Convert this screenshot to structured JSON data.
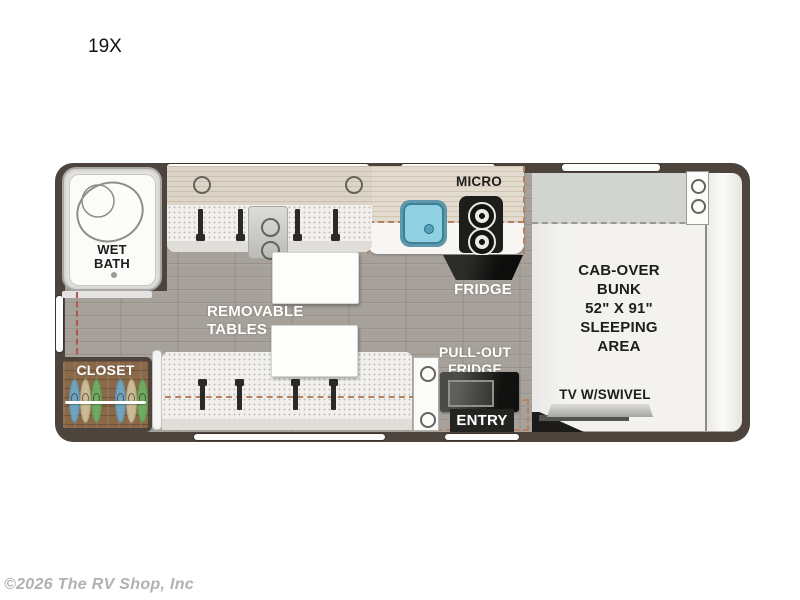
{
  "header": {
    "model_label": "19X"
  },
  "footer": {
    "copyright": "©2026 The RV Shop, Inc"
  },
  "floorplan": {
    "bath": {
      "label": "WET\nBATH"
    },
    "closet": {
      "label": "CLOSET",
      "hanger_colors": [
        "blue",
        "tan",
        "green",
        "blue",
        "tan",
        "green"
      ]
    },
    "dinette": {
      "label": "REMOVABLE\nTABLES",
      "seat_belt_count": 8,
      "table_count": 2
    },
    "kitchen": {
      "micro_label": "MICRO",
      "fridge_label": "FRIDGE"
    },
    "entry": {
      "pull_out_fridge_label": "PULL-OUT\nFRIDGE",
      "entry_label": "ENTRY"
    },
    "bunk": {
      "label": "CAB-OVER\nBUNK\n52\" X 91\"\nSLEEPING\nAREA",
      "tv_label": "TV W/SWIVEL"
    },
    "colors": {
      "wall": "#4c443d",
      "floor": "#a6a19a",
      "bench": "#f1f0ed",
      "cabinet_wood": "#dcd4c6",
      "closet_wood": "#8a6848",
      "sink": "#8fd0e2",
      "cab_gray": "#d2d4d1",
      "label_white": "#ffffff",
      "label_dark": "#1d1d1b",
      "hanger_blue": "#6fa8c4",
      "hanger_tan": "#cfc09a",
      "hanger_green": "#6fae62"
    }
  }
}
